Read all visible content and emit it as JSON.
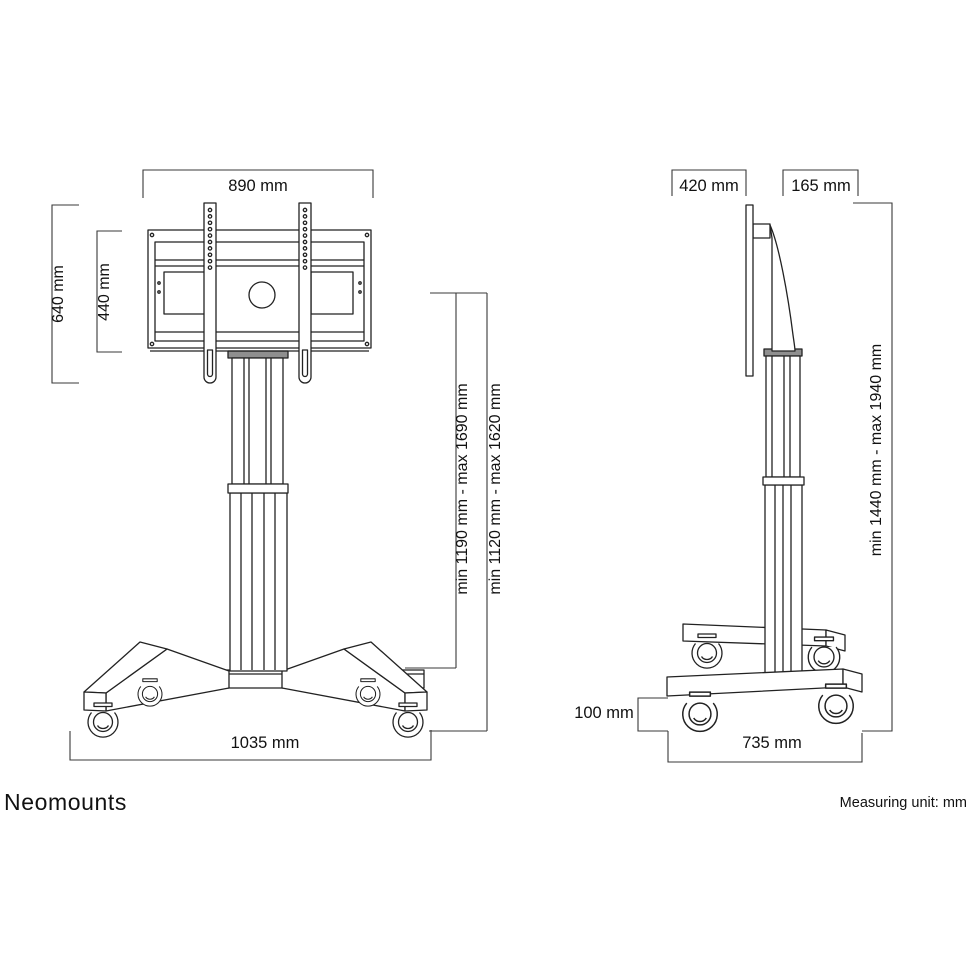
{
  "branding": {
    "logo": "Neomounts"
  },
  "footer": {
    "measuring_unit": "Measuring unit: mm"
  },
  "front_view": {
    "dims": {
      "plate_width": "890 mm",
      "bracket_height": "640 mm",
      "plate_height": "440 mm",
      "screen_center_height_range": "min 1190 mm - max 1690 mm",
      "secondary_height_range": "min 1120 mm - max 1620 mm",
      "base_width": "1035 mm"
    }
  },
  "side_view": {
    "dims": {
      "screen_depth": "420 mm",
      "column_depth": "165 mm",
      "total_height_range": "min 1440 mm - max 1940 mm",
      "base_height": "100 mm",
      "base_depth": "735 mm"
    }
  },
  "colors": {
    "background": "#ffffff",
    "line": "#222222",
    "dimension_line": "#3a3a3a",
    "text": "#111111",
    "column_cap": "#8f8f8f",
    "logo": "#6e757c"
  }
}
